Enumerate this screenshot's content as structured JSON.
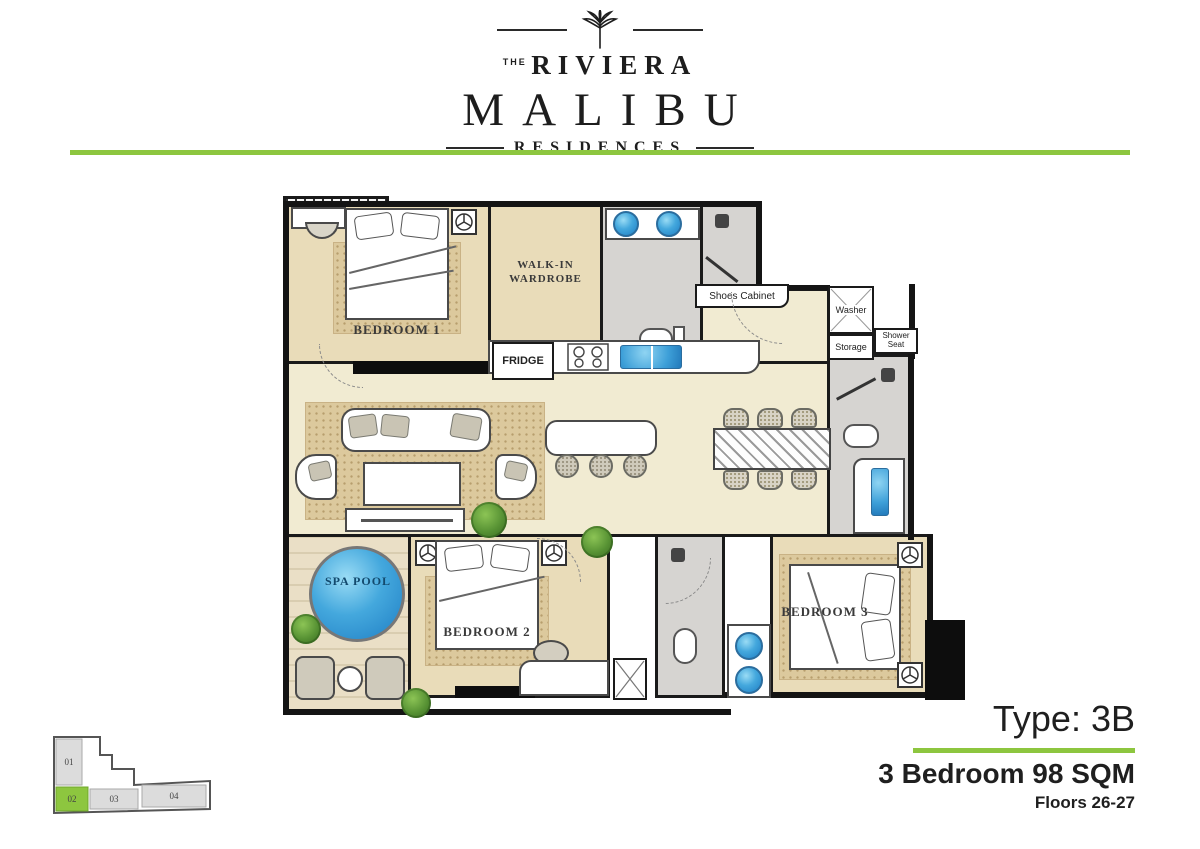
{
  "brand": {
    "the": "THE",
    "name": "RIVIERA",
    "title": "MALIBU",
    "subtitle": "RESIDENCES"
  },
  "colors": {
    "accent_green": "#8dc63f",
    "floor_beige": "#f1ebd2",
    "floor_tan": "#e9dcb9",
    "floor_gray": "#d6d4d1",
    "water_blue": "#3d9fd8",
    "wall_black": "#1a1a1a"
  },
  "plan": {
    "rooms": {
      "bedroom1": "BEDROOM 1",
      "walkin": "WALK-IN WARDROBE",
      "fridge": "FRIDGE",
      "shoes_cabinet": "Shoes Cabinet",
      "washer": "Washer",
      "storage": "Storage",
      "shower_seat": "Shower Seat",
      "spa_pool": "SPA POOL",
      "bedroom2": "BEDROOM 2",
      "bedroom3": "BEDROOM 3"
    }
  },
  "info": {
    "type_label": "Type: 3B",
    "spec": "3 Bedroom  98 SQM",
    "floors": "Floors 26-27"
  },
  "minimap": {
    "units": [
      {
        "label": "01",
        "highlight": false
      },
      {
        "label": "02",
        "highlight": true
      },
      {
        "label": "03",
        "highlight": false
      },
      {
        "label": "04",
        "highlight": false
      }
    ]
  }
}
